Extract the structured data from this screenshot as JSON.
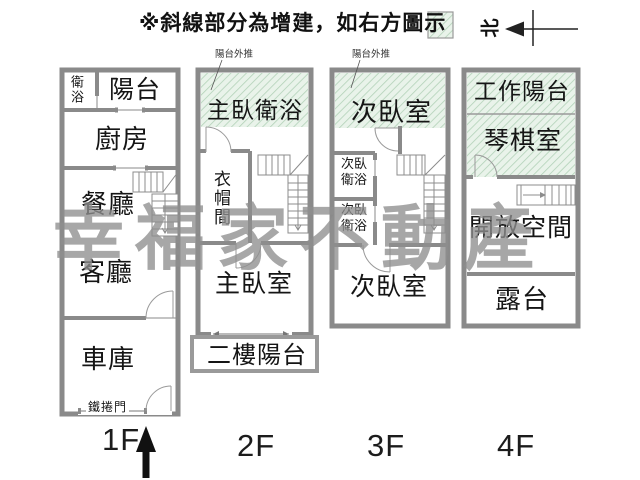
{
  "header": {
    "note": "※斜線部分為增建，如右方圖示",
    "north": "北"
  },
  "watermark": {
    "text": "幸福家不動產"
  },
  "annotations": {
    "balcony_out_2f": "陽台外推",
    "balcony_out_3f": "陽台外推"
  },
  "floors": {
    "f1": {
      "label": "1F",
      "rooms": {
        "bath": "衛浴",
        "balcony": "陽台",
        "kitchen": "廚房",
        "dining": "餐廳",
        "living": "客廳",
        "garage": "車庫",
        "rolling_door": "鐵捲門"
      }
    },
    "f2": {
      "label": "2F",
      "rooms": {
        "master_bath": "主臥衛浴",
        "closet": "衣帽間",
        "master_bedroom": "主臥室",
        "balcony": "二樓陽台"
      }
    },
    "f3": {
      "label": "3F",
      "rooms": {
        "bedroom_upper": "次臥室",
        "bath_1": "次臥衛浴",
        "bath_2": "次臥衛浴",
        "bedroom_lower": "次臥室"
      }
    },
    "f4": {
      "label": "4F",
      "rooms": {
        "work_balcony": "工作陽台",
        "piano_room": "琴棋室",
        "open_space": "開放空間",
        "terrace": "露台"
      }
    }
  },
  "colors": {
    "wall_gray": "#8a8a8a",
    "hatch_green_bg": "#e9f3ea",
    "hatch_green_line": "#b2d2b8",
    "watermark_gray": "#8f8f8f",
    "text_black": "#151515"
  }
}
